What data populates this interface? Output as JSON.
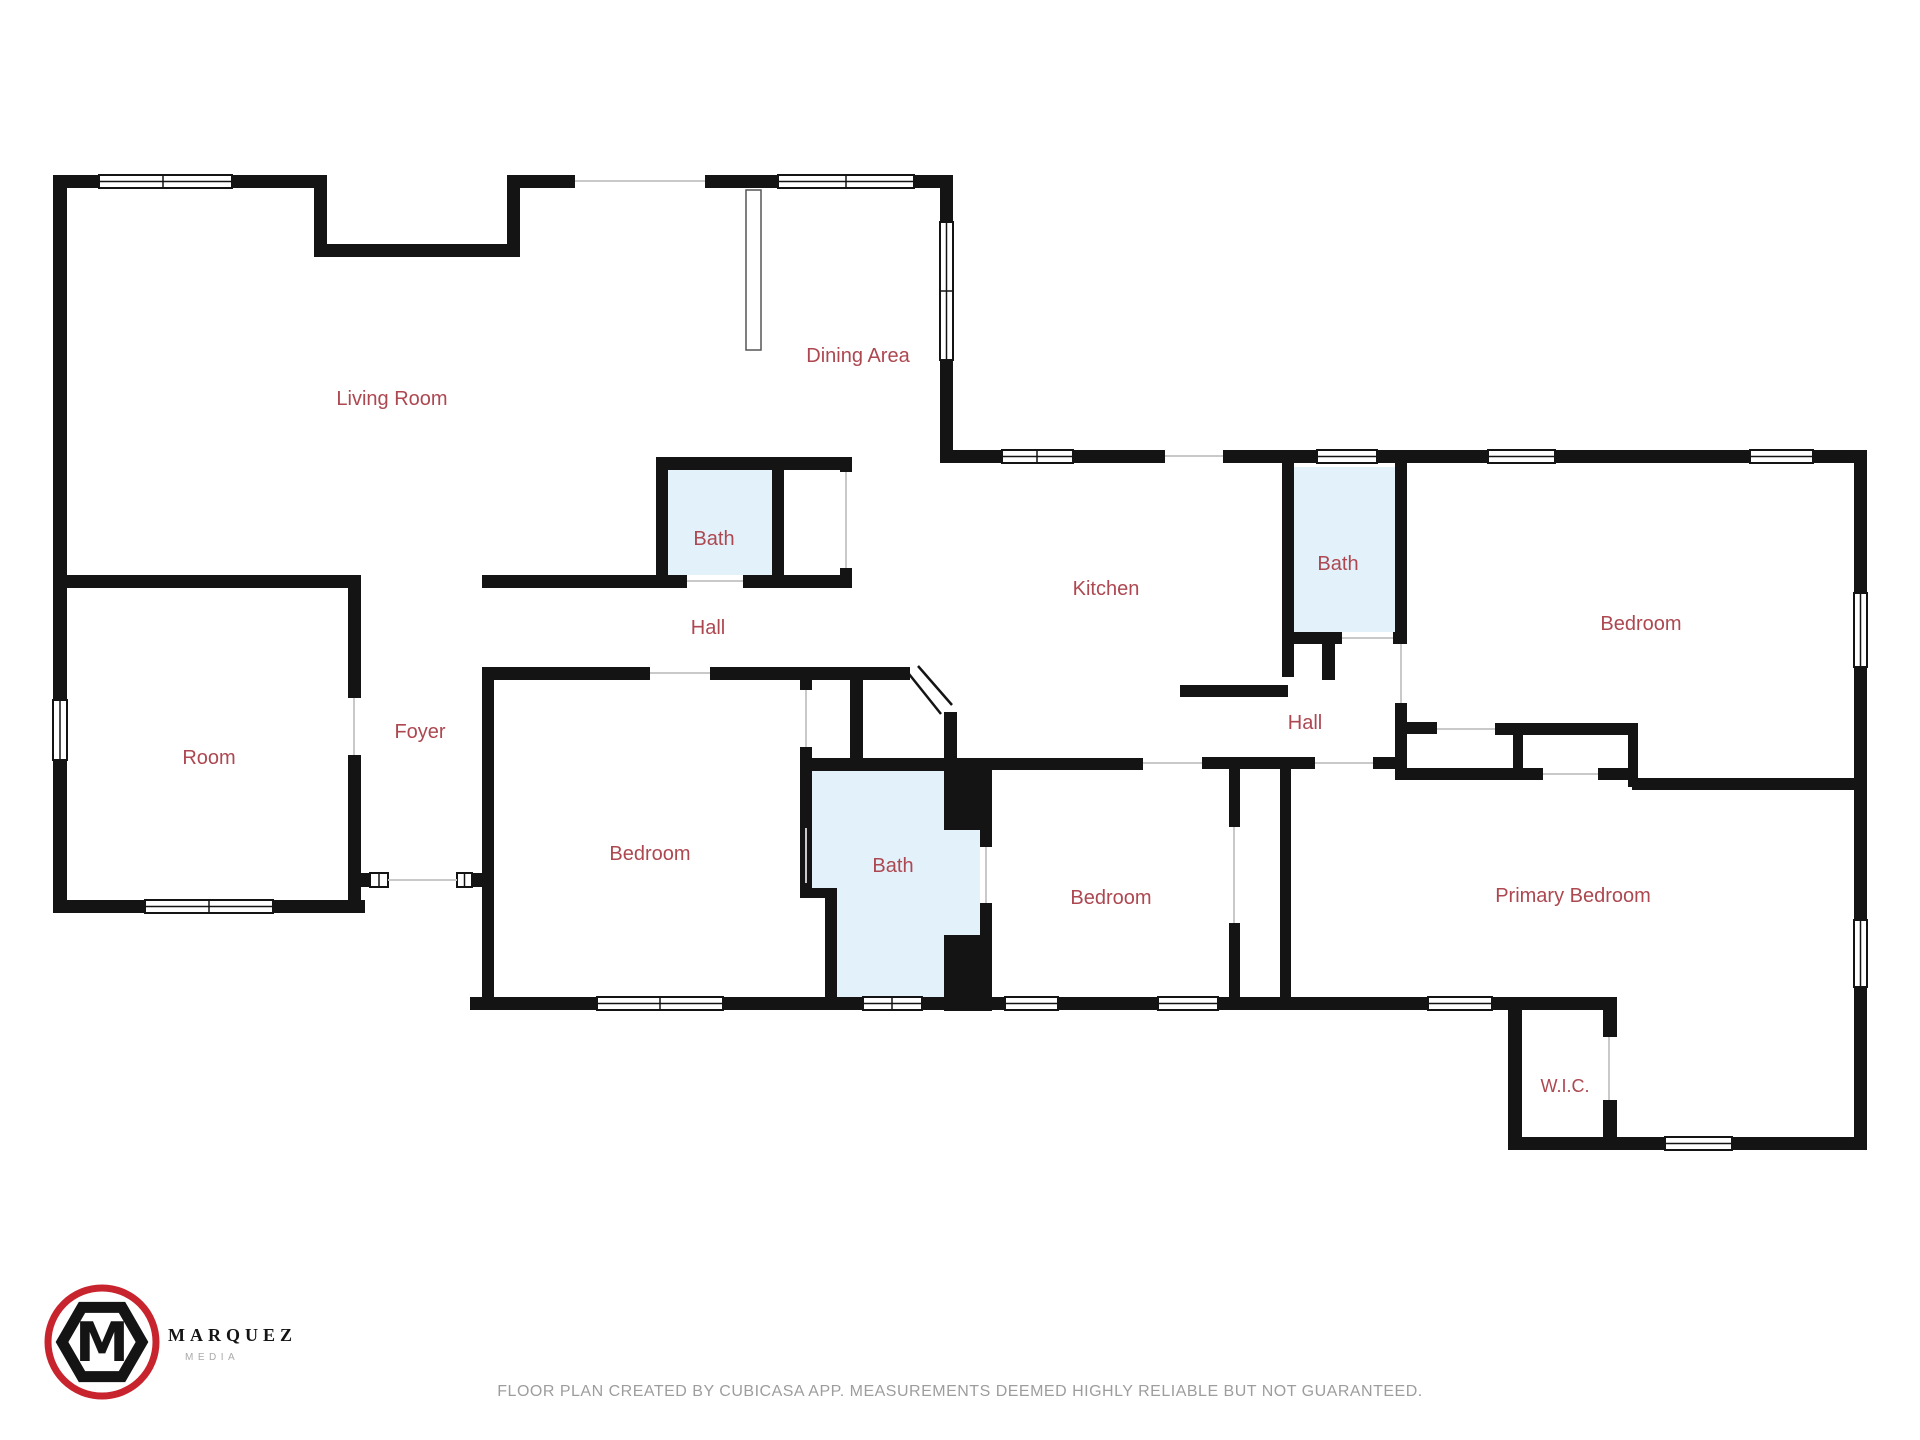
{
  "rooms": [
    {
      "id": "living-room",
      "label": "Living Room"
    },
    {
      "id": "dining-area",
      "label": "Dining Area"
    },
    {
      "id": "bath-hall",
      "label": "Bath"
    },
    {
      "id": "hall-center",
      "label": "Hall"
    },
    {
      "id": "kitchen",
      "label": "Kitchen"
    },
    {
      "id": "bath-right",
      "label": "Bath"
    },
    {
      "id": "bedroom-right",
      "label": "Bedroom"
    },
    {
      "id": "room",
      "label": "Room"
    },
    {
      "id": "foyer",
      "label": "Foyer"
    },
    {
      "id": "bedroom-left",
      "label": "Bedroom"
    },
    {
      "id": "bath-middle",
      "label": "Bath"
    },
    {
      "id": "bedroom-middle",
      "label": "Bedroom"
    },
    {
      "id": "hall-right",
      "label": "Hall"
    },
    {
      "id": "primary-bedroom",
      "label": "Primary Bedroom"
    },
    {
      "id": "wic",
      "label": "W.I.C."
    }
  ],
  "branding": {
    "logo_monogram": "M",
    "logo_text": "MARQUEZ",
    "logo_subtext": "MEDIA"
  },
  "footer": {
    "disclaimer": "FLOOR PLAN CREATED BY CUBICASA APP. MEASUREMENTS DEEMED HIGHLY RELIABLE BUT NOT GUARANTEED."
  },
  "colors": {
    "wall": "#141414",
    "bath_fill": "#e3f1fb",
    "label": "#ad4750",
    "disclaimer": "#9d9d9d",
    "logo_red": "#c8242e",
    "opening": "#c9c9c9"
  }
}
